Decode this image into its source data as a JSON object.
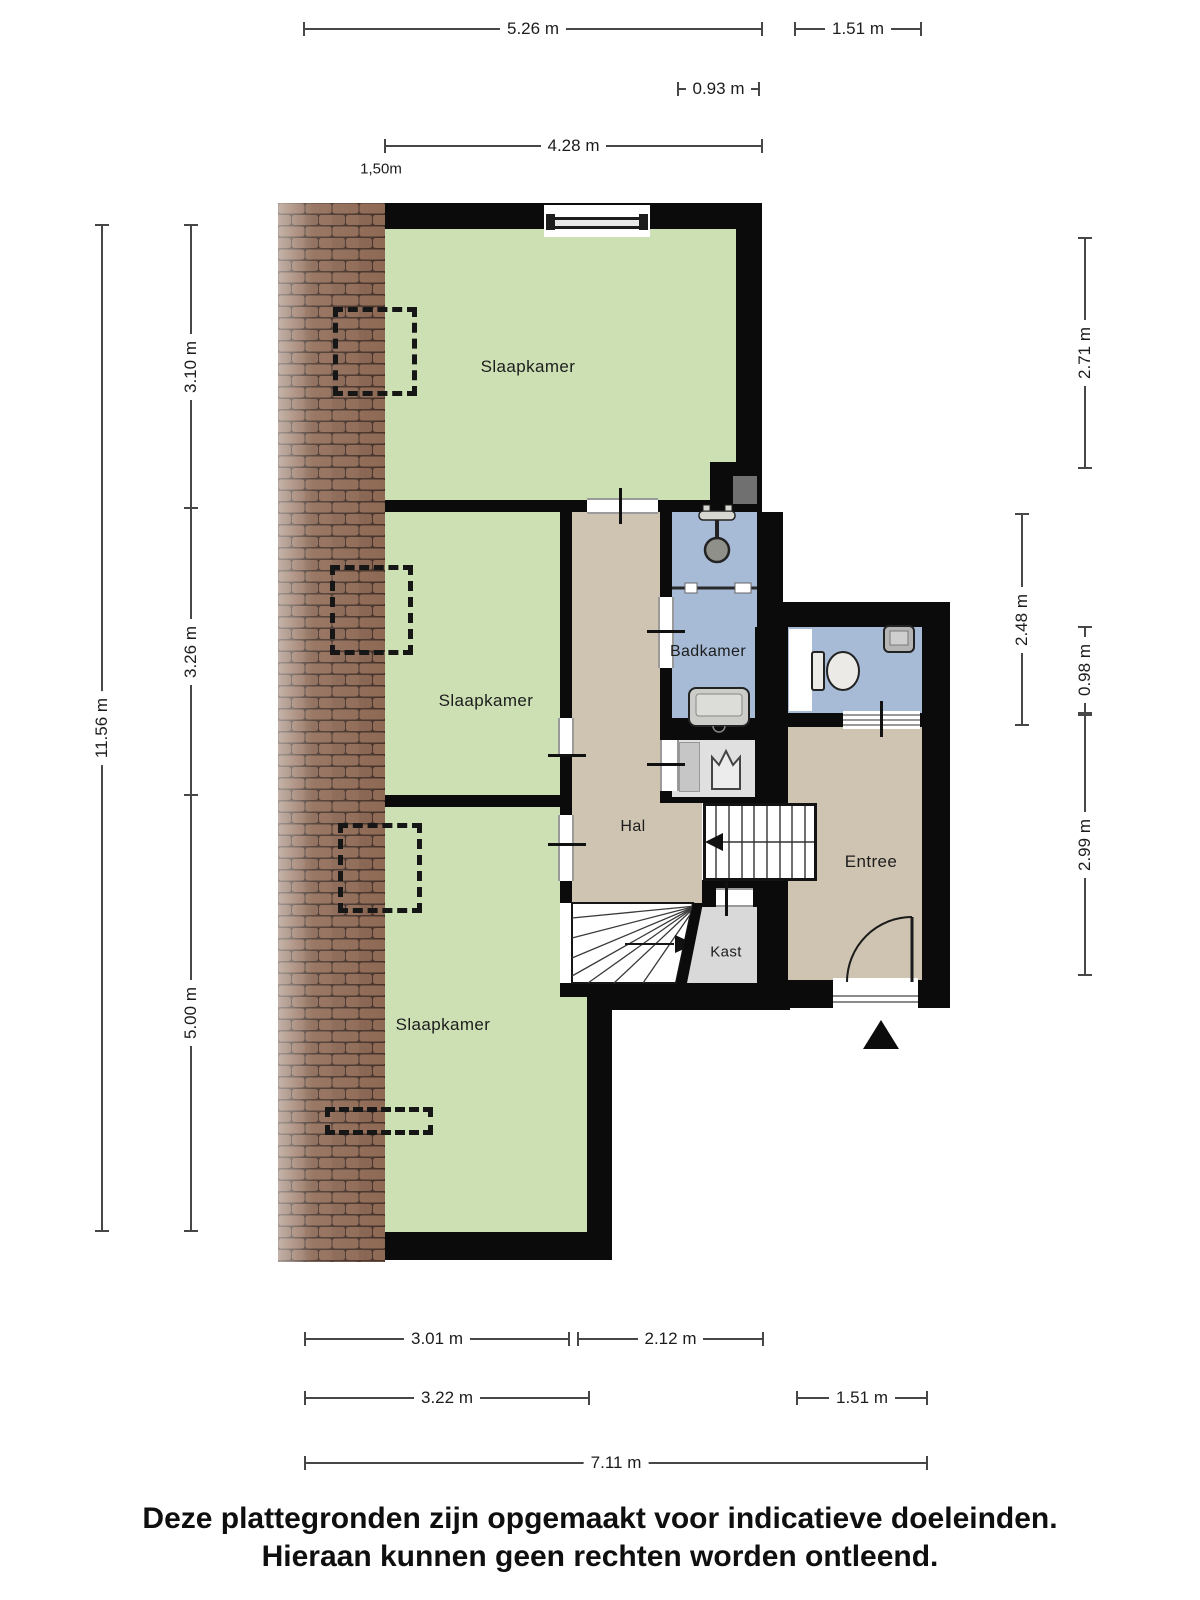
{
  "disclaimer": {
    "line1": "Deze plattegronden zijn opgemaakt voor indicatieve doeleinden.",
    "line2": "Hieraan kunnen geen rechten worden ontleend."
  },
  "rooms": [
    {
      "label": "Slaapkamer",
      "x": 528,
      "y": 367,
      "size": 17
    },
    {
      "label": "Slaapkamer",
      "x": 486,
      "y": 701,
      "size": 17
    },
    {
      "label": "Slaapkamer",
      "x": 443,
      "y": 1025,
      "size": 17
    },
    {
      "label": "Badkamer",
      "x": 708,
      "y": 652,
      "size": 16
    },
    {
      "label": "Hal",
      "x": 633,
      "y": 827,
      "size": 16
    },
    {
      "label": "Entree",
      "x": 871,
      "y": 862,
      "size": 17
    },
    {
      "label": "Kast",
      "x": 726,
      "y": 952,
      "size": 15
    }
  ],
  "free_labels": [
    {
      "label": "1,50m",
      "x": 381,
      "y": 169,
      "size": 15
    }
  ],
  "dimensions": [
    {
      "label": "5.26 m",
      "dir": "h",
      "pos": 29,
      "from": 304,
      "to": 762
    },
    {
      "label": "1.51 m",
      "dir": "h",
      "pos": 29,
      "from": 795,
      "to": 921
    },
    {
      "label": "0.93 m",
      "dir": "h",
      "pos": 89,
      "from": 678,
      "to": 759
    },
    {
      "label": "4.28 m",
      "dir": "h",
      "pos": 146,
      "from": 385,
      "to": 762
    },
    {
      "label": "3.01 m",
      "dir": "h",
      "pos": 1339,
      "from": 305,
      "to": 569
    },
    {
      "label": "2.12 m",
      "dir": "h",
      "pos": 1339,
      "from": 578,
      "to": 763
    },
    {
      "label": "3.22 m",
      "dir": "h",
      "pos": 1398,
      "from": 305,
      "to": 589
    },
    {
      "label": "1.51 m",
      "dir": "h",
      "pos": 1398,
      "from": 797,
      "to": 927
    },
    {
      "label": "7.11 m",
      "dir": "h",
      "pos": 1463,
      "from": 305,
      "to": 927
    },
    {
      "label": "11.56 m",
      "dir": "v",
      "pos": 102,
      "from": 225,
      "to": 1231
    },
    {
      "label": "3.10 m",
      "dir": "v",
      "pos": 191,
      "from": 225,
      "to": 508
    },
    {
      "label": "3.26 m",
      "dir": "v",
      "pos": 191,
      "from": 508,
      "to": 795
    },
    {
      "label": "5.00 m",
      "dir": "v",
      "pos": 191,
      "from": 795,
      "to": 1231
    },
    {
      "label": "2.71 m",
      "dir": "v",
      "pos": 1085,
      "from": 238,
      "to": 468
    },
    {
      "label": "2.48 m",
      "dir": "v",
      "pos": 1022,
      "from": 514,
      "to": 725
    },
    {
      "label": "0.98 m",
      "dir": "v",
      "pos": 1085,
      "from": 627,
      "to": 713
    },
    {
      "label": "2.99 m",
      "dir": "v",
      "pos": 1085,
      "from": 715,
      "to": 975
    }
  ],
  "icons": {
    "shower-icon": "svg-shape",
    "toilet-icon": "svg-shape",
    "corner-sink-icon": "svg-shape",
    "washbasin-icon": "svg-shape",
    "sink-crown-icon": "svg-shape",
    "stairs-straight-icon": "svg-lines-arrow",
    "stairs-winder-icon": "svg-fan-arrow",
    "door-arc-icon": "svg-arc",
    "entrance-arrow-icon": "svg-triangle",
    "window-icon": "css-rect",
    "roof-tiles-texture": "svg-pattern",
    "roof-window-outline": "css-dashed-rect"
  },
  "colors": {
    "walls": "#0b0b0b",
    "bedroom_green": "#cde0b4",
    "wet_room_blue": "#a7bbd7",
    "hall_beige": "#cfc3b1",
    "closet_gray": "#d9d9d9",
    "tile_brown": "#8e6954",
    "chimney_gray": "#707070",
    "dimension_line": "#474747",
    "text": "#1c1c1c"
  }
}
